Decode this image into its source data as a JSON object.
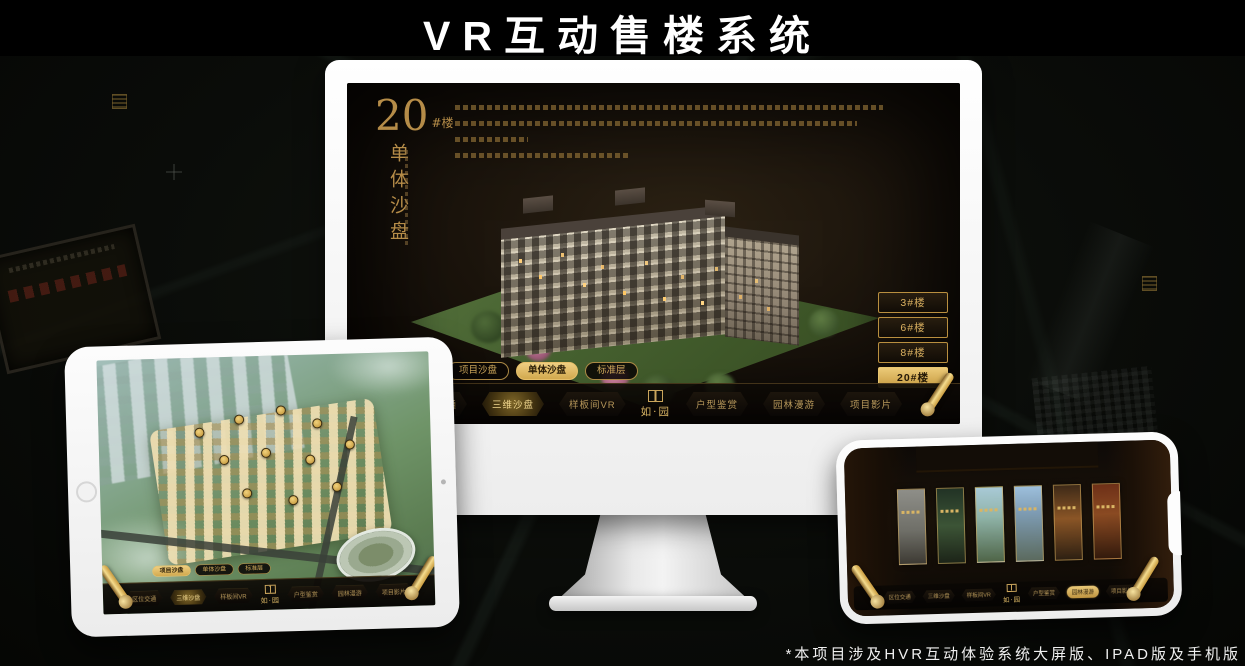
{
  "page": {
    "title": "VR互动售楼系统",
    "footnote": "*本项目涉及HVR互动体验系统大屏版、IPAD版及手机版"
  },
  "colors": {
    "gold": "#c9a45a",
    "gold_bright": "#ecca78",
    "screen_background": "#1b140c",
    "selected_text": "#241806",
    "title_text": "#ffffff"
  },
  "brand": {
    "logo_text": "如·园"
  },
  "monitor_app": {
    "heading": {
      "number": "20",
      "suffix": "#楼",
      "subtitle_vertical": "单体沙盘"
    },
    "building_buttons": [
      {
        "label": "3#楼",
        "selected": false
      },
      {
        "label": "6#楼",
        "selected": false
      },
      {
        "label": "8#楼",
        "selected": false
      },
      {
        "label": "20#楼",
        "selected": true
      }
    ],
    "sub_tabs": [
      {
        "label": "项目沙盘",
        "selected": false
      },
      {
        "label": "单体沙盘",
        "selected": true
      },
      {
        "label": "标准层",
        "selected": false
      }
    ],
    "nav": {
      "logo": "如·园",
      "items": [
        {
          "label": "区位交通",
          "selected": false
        },
        {
          "label": "三维沙盘",
          "selected": true
        },
        {
          "label": "样板间VR",
          "selected": false
        },
        {
          "label": "户型鉴赏",
          "selected": false
        },
        {
          "label": "园林漫游",
          "selected": false
        },
        {
          "label": "项目影片",
          "selected": false
        }
      ]
    }
  },
  "tablet_app": {
    "sub_tabs": [
      {
        "label": "项目沙盘",
        "selected": true
      },
      {
        "label": "单体沙盘",
        "selected": false
      },
      {
        "label": "标准层",
        "selected": false
      }
    ],
    "nav": {
      "logo": "如·园",
      "items": [
        {
          "label": "区位交通",
          "selected": false
        },
        {
          "label": "三维沙盘",
          "selected": true
        },
        {
          "label": "样板间VR",
          "selected": false
        },
        {
          "label": "户型鉴赏",
          "selected": false
        },
        {
          "label": "园林漫游",
          "selected": false
        },
        {
          "label": "项目影片",
          "selected": false
        }
      ]
    }
  },
  "phone_app": {
    "gallery_count": 6,
    "nav": {
      "logo": "如·园",
      "items": [
        {
          "label": "区位交通",
          "selected": false
        },
        {
          "label": "三维沙盘",
          "selected": false
        },
        {
          "label": "样板间VR",
          "selected": false
        },
        {
          "label": "户型鉴赏",
          "selected": false
        },
        {
          "label": "园林漫游",
          "selected": true
        },
        {
          "label": "项目影片",
          "selected": false
        }
      ]
    }
  }
}
